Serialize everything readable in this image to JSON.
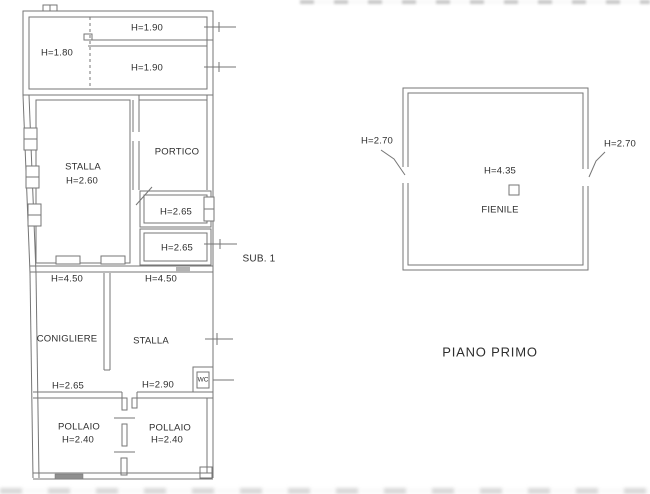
{
  "colors": {
    "line": "#767676",
    "text": "#2e2e2e",
    "background": "#ffffff"
  },
  "ground_floor": {
    "labels": {
      "attic_left": "H=1.80",
      "attic_upper": "H=1.90",
      "attic_lower": "H=1.90",
      "stalla_name": "STALLA",
      "stalla_height": "H=2.60",
      "portico": "PORTICO",
      "room_a_height": "H=2.65",
      "room_b_height": "H=2.65",
      "span_left": "H=4.50",
      "span_right": "H=4.50",
      "conigliere": "CONIGLIERE",
      "stalla_lower": "STALLA",
      "wc": "WC",
      "conigliere_height": "H=2.65",
      "stalla_lower_height": "H=2.90",
      "pollaio_left": "POLLAIO",
      "pollaio_left_height": "H=2.40",
      "pollaio_right": "POLLAIO",
      "pollaio_right_height": "H=2.40",
      "sub_unit": "SUB. 1"
    }
  },
  "first_floor": {
    "labels": {
      "wall_left_height": "H=2.70",
      "wall_right_height": "H=2.70",
      "room_height": "H=4.35",
      "room_name": "FIENILE"
    },
    "title": "PIANO PRIMO"
  }
}
